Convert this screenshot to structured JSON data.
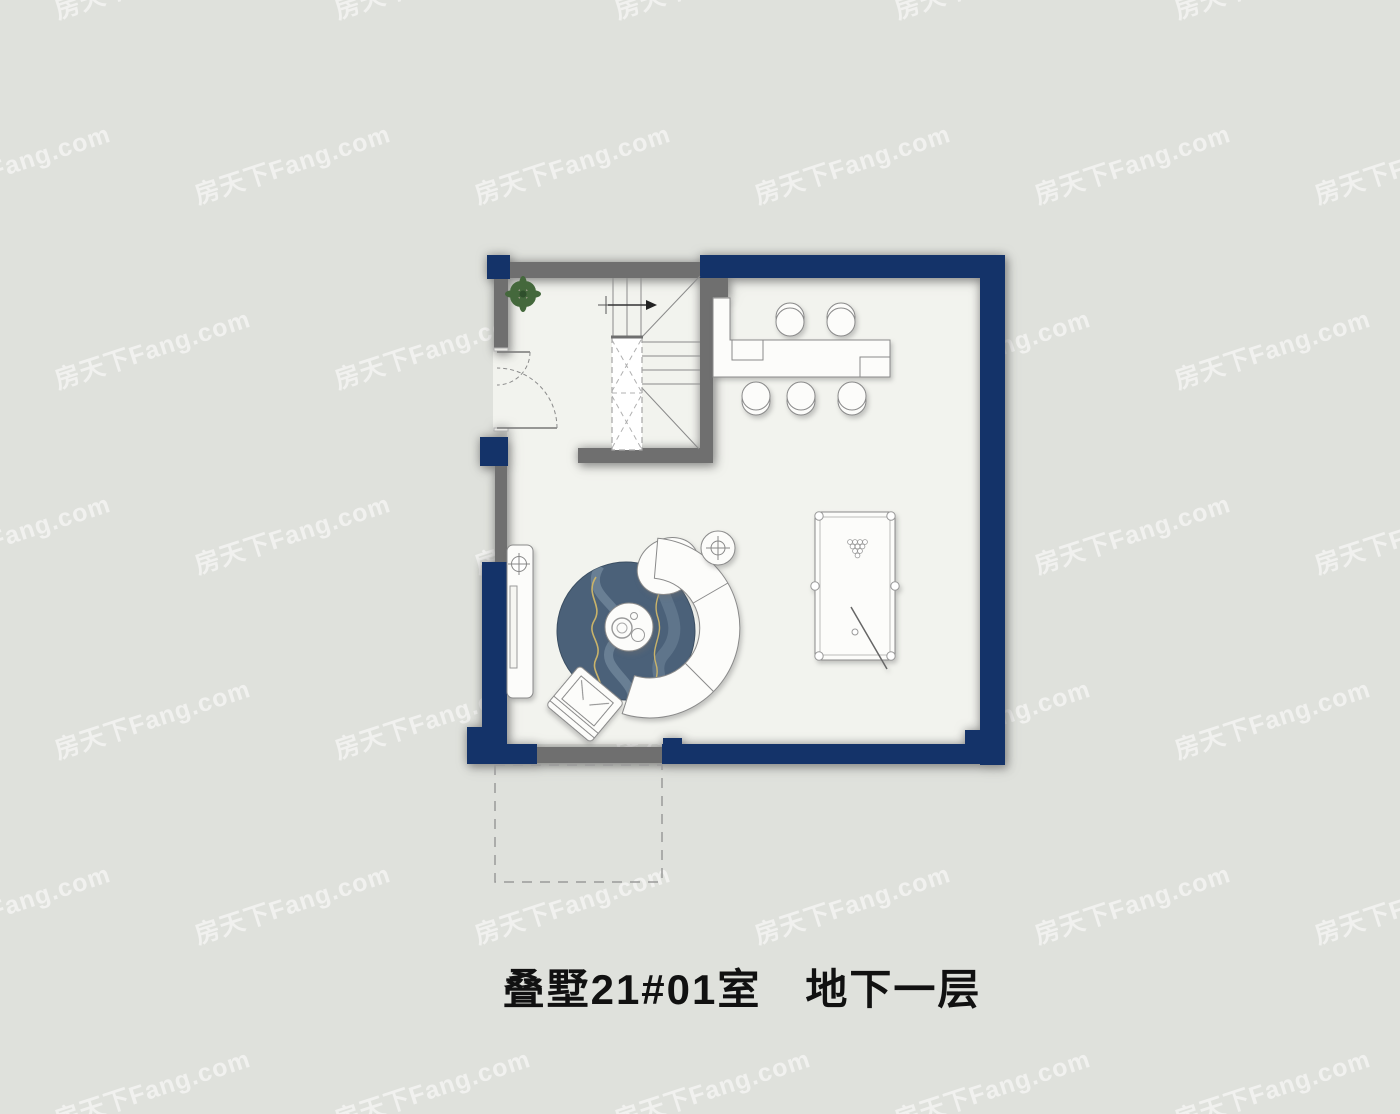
{
  "page": {
    "title": "叠墅21#01室　地下一层",
    "watermark": "房天下Fang.com"
  },
  "colors": {
    "background": "#dfe1dc",
    "floor": "#f2f3ee",
    "wall_navy": "#143369",
    "wall_gray": "#6f6f6f",
    "rug": "#4b6179",
    "rug_wave": "#8ea4b5",
    "rug_gold": "#c9b36a",
    "plant_green": "#44683c",
    "plant_dark": "#2f4f2c",
    "outline": "#8a8a8a",
    "title_text": "#111111",
    "watermark_color": "rgba(255,255,255,0.55)"
  }
}
